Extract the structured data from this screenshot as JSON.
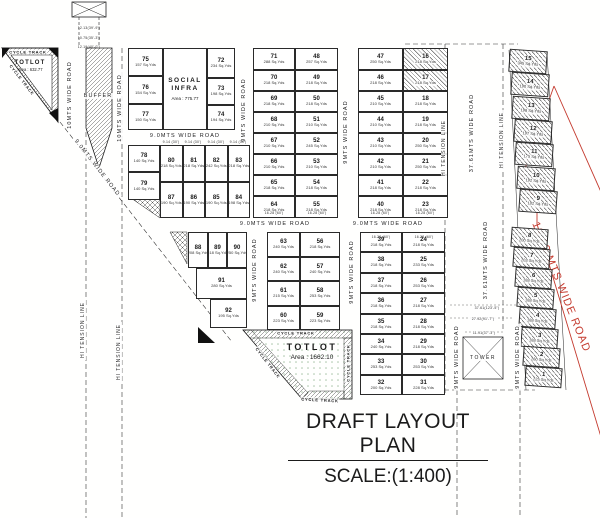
{
  "title": {
    "heading": "DRAFT LAYOUT PLAN",
    "scale": "SCALE:(1:400)"
  },
  "colors": {
    "red": "#c43a2e",
    "ink": "#222222"
  },
  "labels": {
    "cycle_track": "CYCLE TRACK",
    "hi_tension": "HI TENSION LINE",
    "buffer": "BUFFER",
    "tower": "TOWER",
    "red_road": "12.19 MTS WIDE ROAD"
  },
  "totlot_top": {
    "name": "TOTLOT",
    "area": "Area : 632.77"
  },
  "totlot_bottom": {
    "name": "TOTLOT",
    "area": "Area : 1662.10"
  },
  "social_infra": {
    "name": "SOCIAL INFRA",
    "area": "Area : 775.77"
  },
  "road_labels": [
    "10MTS WIDE ROAD",
    "10MTS WIDE ROAD",
    "9.0MTS WIDE ROAD",
    "9.0MTS WIDE ROAD",
    "9MTS WIDE ROAD",
    "9MTS WIDE ROAD",
    "9.0MTS WIDE ROAD",
    "9.0MTS WIDE ROAD",
    "9MTS WIDE ROAD",
    "9MTS WIDE ROAD",
    "9MTS WIDE ROAD",
    "9MTS WIDE ROAD",
    "37.61MTS WIDE ROAD",
    "37.61MTS WIDE ROAD"
  ],
  "dims": {
    "top": [
      "12.13(39'-9\")",
      "10.75(35'-3\")",
      "12.19(40'-0\")"
    ],
    "tower": [
      "37.61(123'-5\")",
      "27.92(91'-7\")",
      "11.91(37'-3\")"
    ],
    "edges": [
      "9.14 (30')",
      "9.14 (30')",
      "9.14 (30')",
      "9.14 (30')",
      "16.28 (60')",
      "16.28 (60')",
      "16.28 (60')",
      "16.28 (60')",
      "16.28 (60')",
      "16.28 (60')"
    ]
  },
  "blocks": {
    "a_left": {
      "plots": [
        {
          "no": "75",
          "area": "157 Sq.Yds"
        },
        {
          "no": "76",
          "area": "154 Sq.Yds"
        },
        {
          "no": "77",
          "area": "150 Sq.Yds"
        }
      ]
    },
    "a_right": {
      "plots": [
        {
          "no": "72",
          "area": "234 Sq.Yds"
        },
        {
          "no": "73",
          "area": "198 Sq.Yds"
        },
        {
          "no": "74",
          "area": "194 Sq.Yds"
        }
      ]
    },
    "b_left": {
      "plots": [
        {
          "no": "78",
          "area": "140 Sq.Yds"
        },
        {
          "no": "79",
          "area": "140 Sq.Yds"
        }
      ]
    },
    "b_grid": {
      "plots": [
        {
          "no": "80",
          "area": "218 Sq.Yds"
        },
        {
          "no": "81",
          "area": "218 Sq.Yds"
        },
        {
          "no": "82",
          "area": "242 Sq.Yds"
        },
        {
          "no": "83",
          "area": "218 Sq.Yds"
        },
        {
          "no": "87",
          "area": "190 Sq.Yds"
        },
        {
          "no": "86",
          "area": "190 Sq.Yds"
        },
        {
          "no": "85",
          "area": "190 Sq.Yds"
        },
        {
          "no": "84",
          "area": "198 Sq.Yds"
        }
      ]
    },
    "c_left": {
      "plots": [
        {
          "no": "71",
          "area": "288 Sq.Yds"
        },
        {
          "no": "70",
          "area": "218 Sq.Yds"
        },
        {
          "no": "69",
          "area": "218 Sq.Yds"
        },
        {
          "no": "68",
          "area": "210 Sq.Yds"
        },
        {
          "no": "67",
          "area": "210 Sq.Yds"
        },
        {
          "no": "66",
          "area": "210 Sq.Yds"
        },
        {
          "no": "65",
          "area": "218 Sq.Yds"
        },
        {
          "no": "64",
          "area": "218 Sq.Yds"
        }
      ]
    },
    "c_right": {
      "plots": [
        {
          "no": "48",
          "area": "257 Sq.Yds"
        },
        {
          "no": "49",
          "area": "218 Sq.Yds"
        },
        {
          "no": "50",
          "area": "218 Sq.Yds"
        },
        {
          "no": "51",
          "area": "210 Sq.Yds"
        },
        {
          "no": "52",
          "area": "245 Sq.Yds"
        },
        {
          "no": "53",
          "area": "210 Sq.Yds"
        },
        {
          "no": "54",
          "area": "218 Sq.Yds"
        },
        {
          "no": "55",
          "area": "218 Sq.Yds"
        }
      ]
    },
    "d_left": {
      "plots": [
        {
          "no": "47",
          "area": "250 Sq.Yds"
        },
        {
          "no": "46",
          "area": "218 Sq.Yds"
        },
        {
          "no": "45",
          "area": "210 Sq.Yds"
        },
        {
          "no": "44",
          "area": "210 Sq.Yds"
        },
        {
          "no": "43",
          "area": "210 Sq.Yds"
        },
        {
          "no": "42",
          "area": "210 Sq.Yds"
        },
        {
          "no": "41",
          "area": "218 Sq.Yds"
        },
        {
          "no": "40",
          "area": "218 Sq.Yds"
        }
      ]
    },
    "d_right": {
      "plots": [
        {
          "no": "16",
          "area": "218 Sq.Yds",
          "hatched": true
        },
        {
          "no": "17",
          "area": "218 Sq.Yds",
          "hatched": true
        },
        {
          "no": "18",
          "area": "218 Sq.Yds"
        },
        {
          "no": "19",
          "area": "218 Sq.Yds"
        },
        {
          "no": "20",
          "area": "250 Sq.Yds"
        },
        {
          "no": "21",
          "area": "250 Sq.Yds"
        },
        {
          "no": "22",
          "area": "218 Sq.Yds"
        },
        {
          "no": "23",
          "area": "218 Sq.Yds"
        }
      ]
    },
    "e": {
      "plots": [
        {
          "no": "88",
          "area": "208 Sq.Yds"
        },
        {
          "no": "89",
          "area": "218 Sq.Yds"
        },
        {
          "no": "90",
          "area": "250 Sq.Yds"
        },
        {
          "no": "91",
          "area": "280 Sq.Yds"
        },
        {
          "no": "92",
          "area": "195 Sq.Yds"
        }
      ]
    },
    "f_left": {
      "plots": [
        {
          "no": "63",
          "area": "240 Sq.Yds"
        },
        {
          "no": "62",
          "area": "240 Sq.Yds"
        },
        {
          "no": "61",
          "area": "215 Sq.Yds"
        },
        {
          "no": "60",
          "area": "223 Sq.Yds"
        }
      ]
    },
    "f_right": {
      "plots": [
        {
          "no": "56",
          "area": "218 Sq.Yds"
        },
        {
          "no": "57",
          "area": "240 Sq.Yds"
        },
        {
          "no": "58",
          "area": "253 Sq.Yds"
        },
        {
          "no": "59",
          "area": "223 Sq.Yds"
        }
      ]
    },
    "g_left": {
      "plots": [
        {
          "no": "39",
          "area": "218 Sq.Yds"
        },
        {
          "no": "38",
          "area": "218 Sq.Yds"
        },
        {
          "no": "37",
          "area": "218 Sq.Yds"
        },
        {
          "no": "36",
          "area": "218 Sq.Yds"
        },
        {
          "no": "35",
          "area": "218 Sq.Yds"
        },
        {
          "no": "34",
          "area": "240 Sq.Yds"
        },
        {
          "no": "33",
          "area": "253 Sq.Yds"
        },
        {
          "no": "32",
          "area": "200 Sq.Yds"
        }
      ]
    },
    "g_right": {
      "plots": [
        {
          "no": "24",
          "area": "218 Sq.Yds"
        },
        {
          "no": "25",
          "area": "233 Sq.Yds"
        },
        {
          "no": "26",
          "area": "253 Sq.Yds"
        },
        {
          "no": "27",
          "area": "218 Sq.Yds"
        },
        {
          "no": "28",
          "area": "218 Sq.Yds"
        },
        {
          "no": "29",
          "area": "218 Sq.Yds"
        },
        {
          "no": "30",
          "area": "253 Sq.Yds"
        },
        {
          "no": "31",
          "area": "228 Sq.Yds"
        }
      ]
    },
    "strip_upper": {
      "plots": [
        {
          "no": "15",
          "area": "345 Sq.Yds",
          "hatched": true
        },
        {
          "no": "14",
          "area": "190 Sq.Yds",
          "hatched": true
        },
        {
          "no": "13",
          "area": "198 Sq.Yds",
          "hatched": true
        },
        {
          "no": "12",
          "area": "197 Sq.Yds",
          "hatched": true
        },
        {
          "no": "11",
          "area": "175 Sq.Yds",
          "hatched": true
        },
        {
          "no": "10",
          "area": "192 Sq.Yds",
          "hatched": true
        },
        {
          "no": "9",
          "area": "182 Sq.Yds",
          "hatched": true
        }
      ]
    },
    "strip_lower": {
      "plots": [
        {
          "no": "8",
          "area": "200 Sq.Yds",
          "hatched": true
        },
        {
          "no": "7",
          "area": "203 Sq.Yds",
          "hatched": true
        },
        {
          "no": "6",
          "area": "188 Sq.Yds",
          "hatched": true
        },
        {
          "no": "5",
          "area": "188 Sq.Yds",
          "hatched": true
        },
        {
          "no": "4",
          "area": "188 Sq.Yds",
          "hatched": true
        },
        {
          "no": "3",
          "area": "188 Sq.Yds",
          "hatched": true
        },
        {
          "no": "2",
          "area": "260 Sq.Yds",
          "hatched": true
        },
        {
          "no": "1",
          "area": "225 Sq.Yds",
          "hatched": true
        }
      ]
    }
  }
}
